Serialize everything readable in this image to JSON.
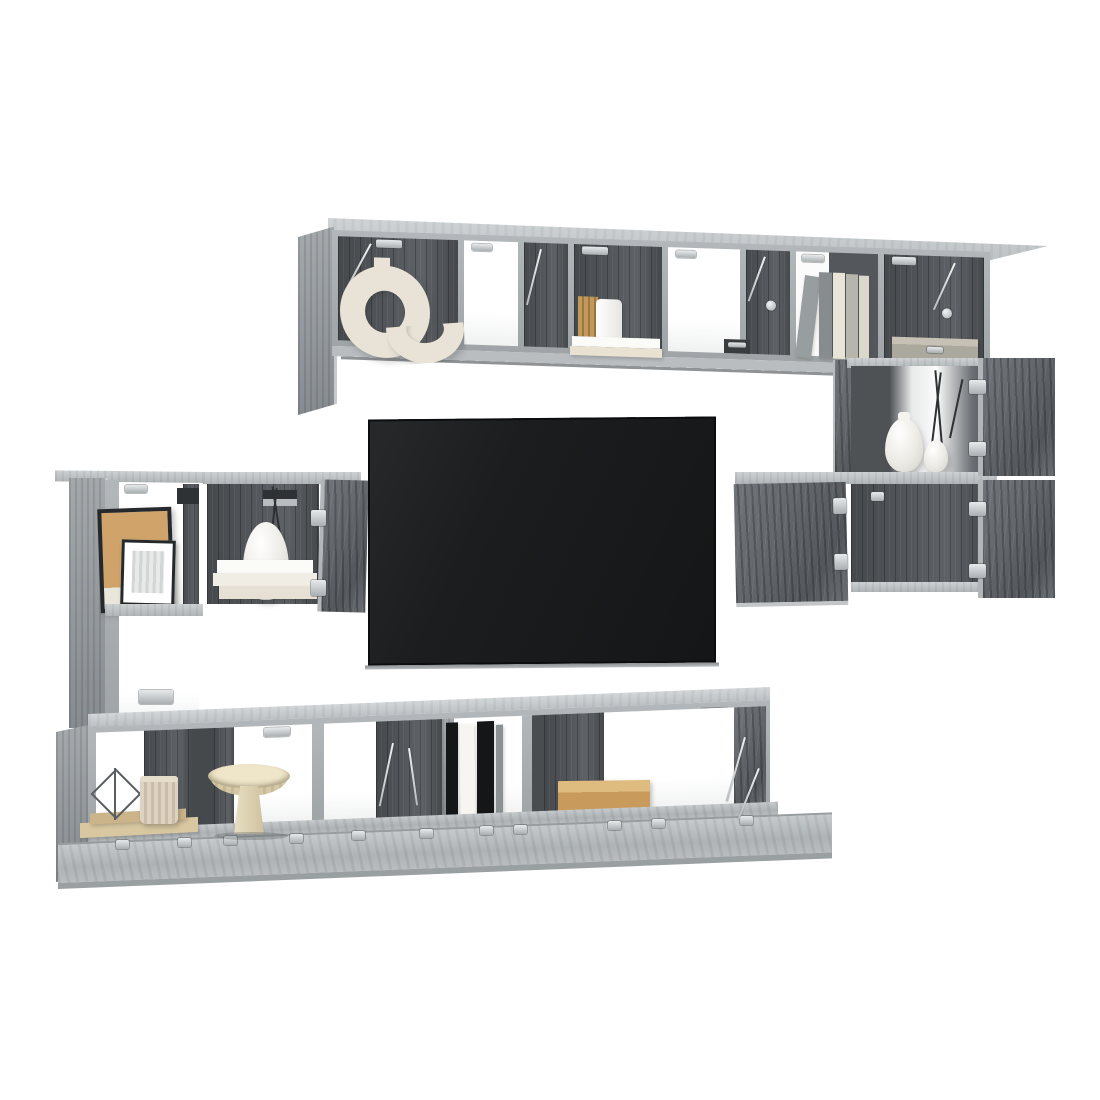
{
  "photo": {
    "description": "Product photo of a grey sonoma wall-mounted TV entertainment cabinet set with open compartments, chrome hinges, decor items and a black flat-screen TV on a white background",
    "background": "#ffffff"
  },
  "palette": {
    "frame": "#a9aeb1",
    "frame_light": "#c8ccce",
    "frame_mid": "#9aa0a3",
    "back_dark": "#54585c",
    "back_darker": "#45494c",
    "door_grain": "#63676b",
    "white_item": "#f4f3ef",
    "cream": "#e8e3d6",
    "beige": "#ddd2b6",
    "tan_wood": "#c89a5c",
    "tan_light": "#debc80",
    "gold": "#c2995a",
    "black_item": "#141618",
    "tv_screen": "#1b1d1e",
    "silver": "#ccd0d2",
    "twig": "#2e3133"
  },
  "units": {
    "top_shelf": {
      "label": "upper wall-mounted shelf row",
      "compartments": 8,
      "open_doors": 1,
      "decor": [
        {
          "id": "ring-sculpture",
          "label": "cream interlocking ring sculpture"
        },
        {
          "id": "book-stack-canister",
          "label": "stacked books with round canister and gold book"
        },
        {
          "id": "upright-books",
          "label": "row of upright books",
          "count": 5
        },
        {
          "id": "storage-box",
          "label": "grey storage box with metal handle"
        }
      ]
    },
    "right_stack": {
      "label": "right wall cabinet stack",
      "rows": 2,
      "open_doors": 4,
      "decor": [
        {
          "id": "white-vases",
          "label": "two white gourd vases with dark twigs",
          "count": 2
        }
      ]
    },
    "left_stack": {
      "label": "left wall cabinet stack",
      "compartments": 3,
      "open_doors": 2,
      "decor": [
        {
          "id": "picture-frames",
          "label": "two leaning black picture frames",
          "count": 2
        },
        {
          "id": "vase-with-branches",
          "label": "white vase with dry branches"
        },
        {
          "id": "white-book-stack",
          "label": "stack of three white books",
          "count": 3
        }
      ]
    },
    "tv": {
      "label": "black flat screen TV"
    },
    "bottom_row": {
      "label": "lower wall-mounted TV bench row with drop-down flaps",
      "compartments": 6,
      "open_flaps": 5,
      "decor": [
        {
          "id": "wire-diamond",
          "label": "wire diamond ornament"
        },
        {
          "id": "ribbed-pot",
          "label": "ribbed cream pot on wooden tray"
        },
        {
          "id": "pedestal-bowl",
          "label": "stone pedestal bowl"
        },
        {
          "id": "folders",
          "label": "upright black and white folders",
          "count": 4
        },
        {
          "id": "wooden-tray",
          "label": "low oak tray"
        }
      ]
    },
    "hardware": {
      "label": "chrome hinges and lid stays"
    }
  }
}
